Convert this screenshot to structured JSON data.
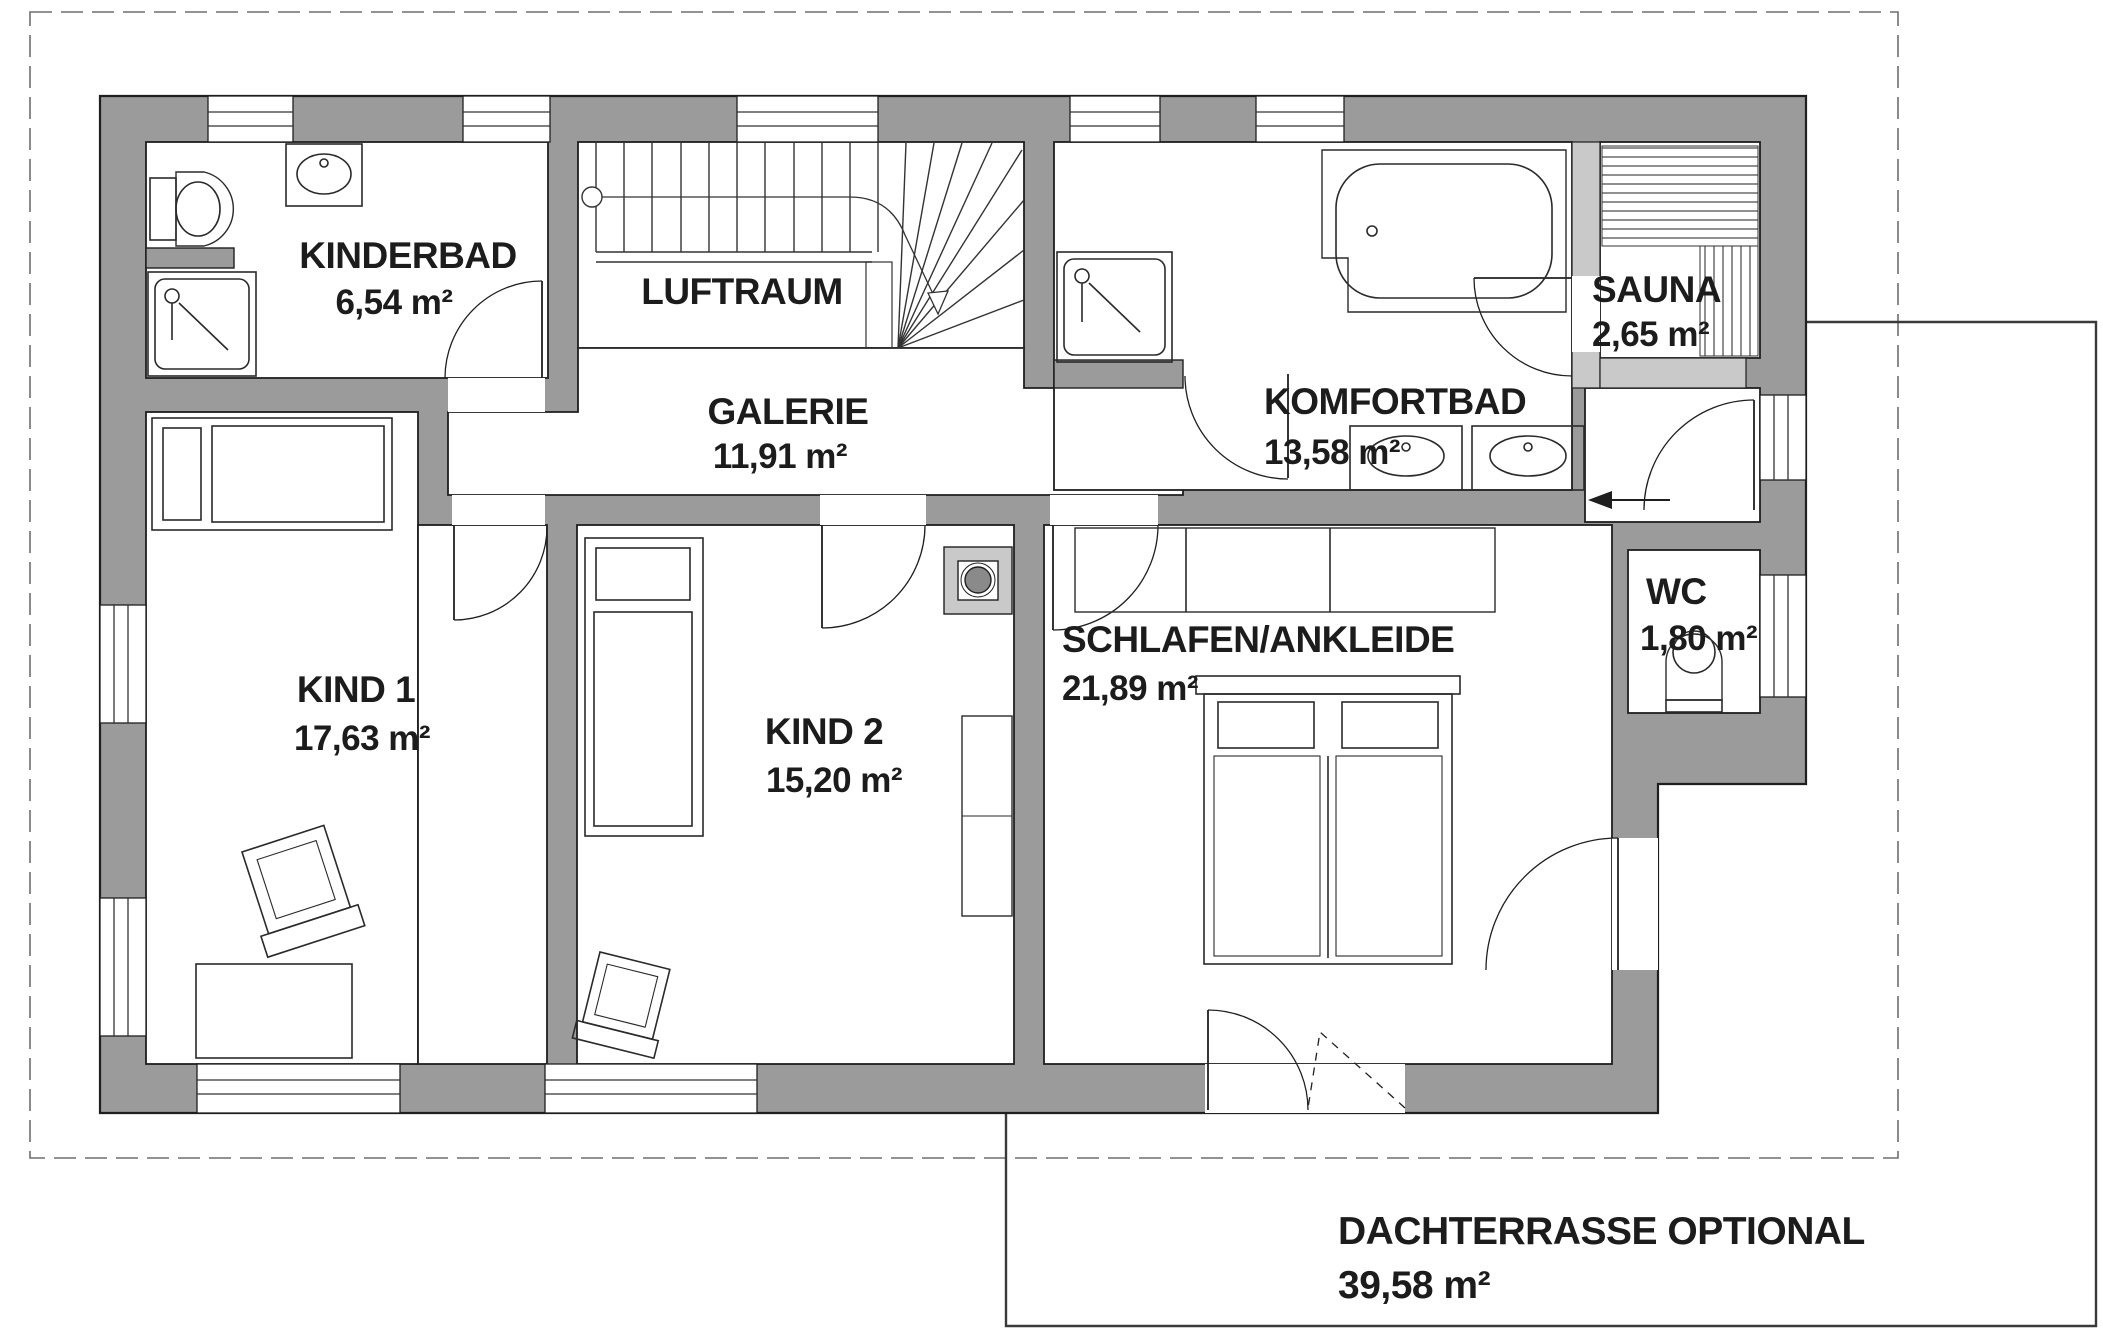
{
  "plan": {
    "title": "Obergeschoss Grundriss",
    "rooms": {
      "kinderbad": {
        "name": "KINDERBAD",
        "area": "6,54 m²"
      },
      "luftraum": {
        "name": "LUFTRAUM",
        "area": ""
      },
      "galerie": {
        "name": "GALERIE",
        "area": "11,91 m²"
      },
      "komfortbad": {
        "name": "KOMFORTBAD",
        "area": "13,58 m²"
      },
      "sauna": {
        "name": "SAUNA",
        "area": "2,65 m²"
      },
      "wc": {
        "name": "WC",
        "area": "1,80 m²"
      },
      "kind1": {
        "name": "KIND 1",
        "area": "17,63 m²"
      },
      "kind2": {
        "name": "KIND 2",
        "area": "15,20 m²"
      },
      "schlafen": {
        "name": "SCHLAFEN/ANKLEIDE",
        "area": "21,89 m²"
      },
      "dachterrasse": {
        "name": "DACHTERRASSE OPTIONAL",
        "area": "39,58 m²"
      }
    },
    "colors": {
      "wall": "#9b9b9b",
      "wall_light": "#c9c9c9",
      "line": "#1f1f1f",
      "dash": "#6e6e6e",
      "background": "#ffffff"
    }
  }
}
